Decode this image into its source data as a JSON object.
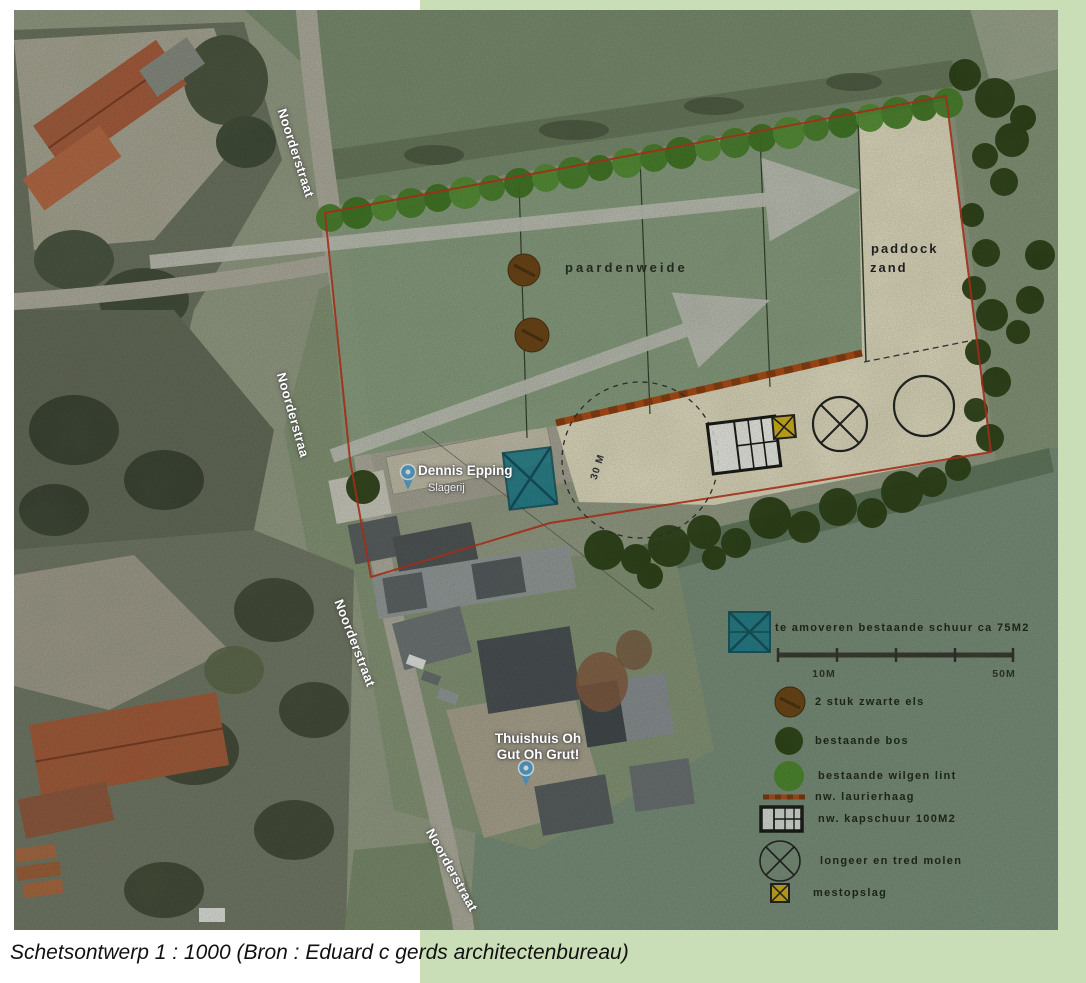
{
  "caption": "Schetsontwerp 1 : 1000 (Bron : Eduard c gerds architectenbureau)",
  "map": {
    "street_labels": [
      "Noorderstraat",
      "Noorderstraa",
      "Noorderstraat",
      "Noorderstraat"
    ],
    "areas": {
      "pasture": "paardenweide",
      "paddock_line1": "paddock",
      "paddock_line2": "zand",
      "radius_note": "30 M"
    },
    "pois": [
      {
        "name": "Dennis Epping",
        "subtitle": "Slagerij"
      },
      {
        "line1": "Thuishuis Oh",
        "line2": "Gut Oh Grut!"
      }
    ]
  },
  "legend": {
    "demolish": "te amoveren bestaande schuur ca 75M2",
    "els": "2 stuk zwarte els",
    "bos": "bestaande bos",
    "wilgen": "bestaande wilgen lint",
    "laurier": "nw. laurierhaag",
    "kapschuur": "nw. kapschuur 100M2",
    "molen": "longeer en tred molen",
    "mest": "mestopslag",
    "scale_left": "10M",
    "scale_right": "50M"
  },
  "colors": {
    "page_green": "#c9deb6",
    "boundary_red": "#c92c15",
    "laurierhaag_orange": "#b8490f",
    "schuur_teal": "#117e92",
    "mestopslag_yellow": "#ddba1a",
    "sand": "#f0e9cd",
    "willow_green": "#447d22",
    "bos_green": "#263c10"
  }
}
